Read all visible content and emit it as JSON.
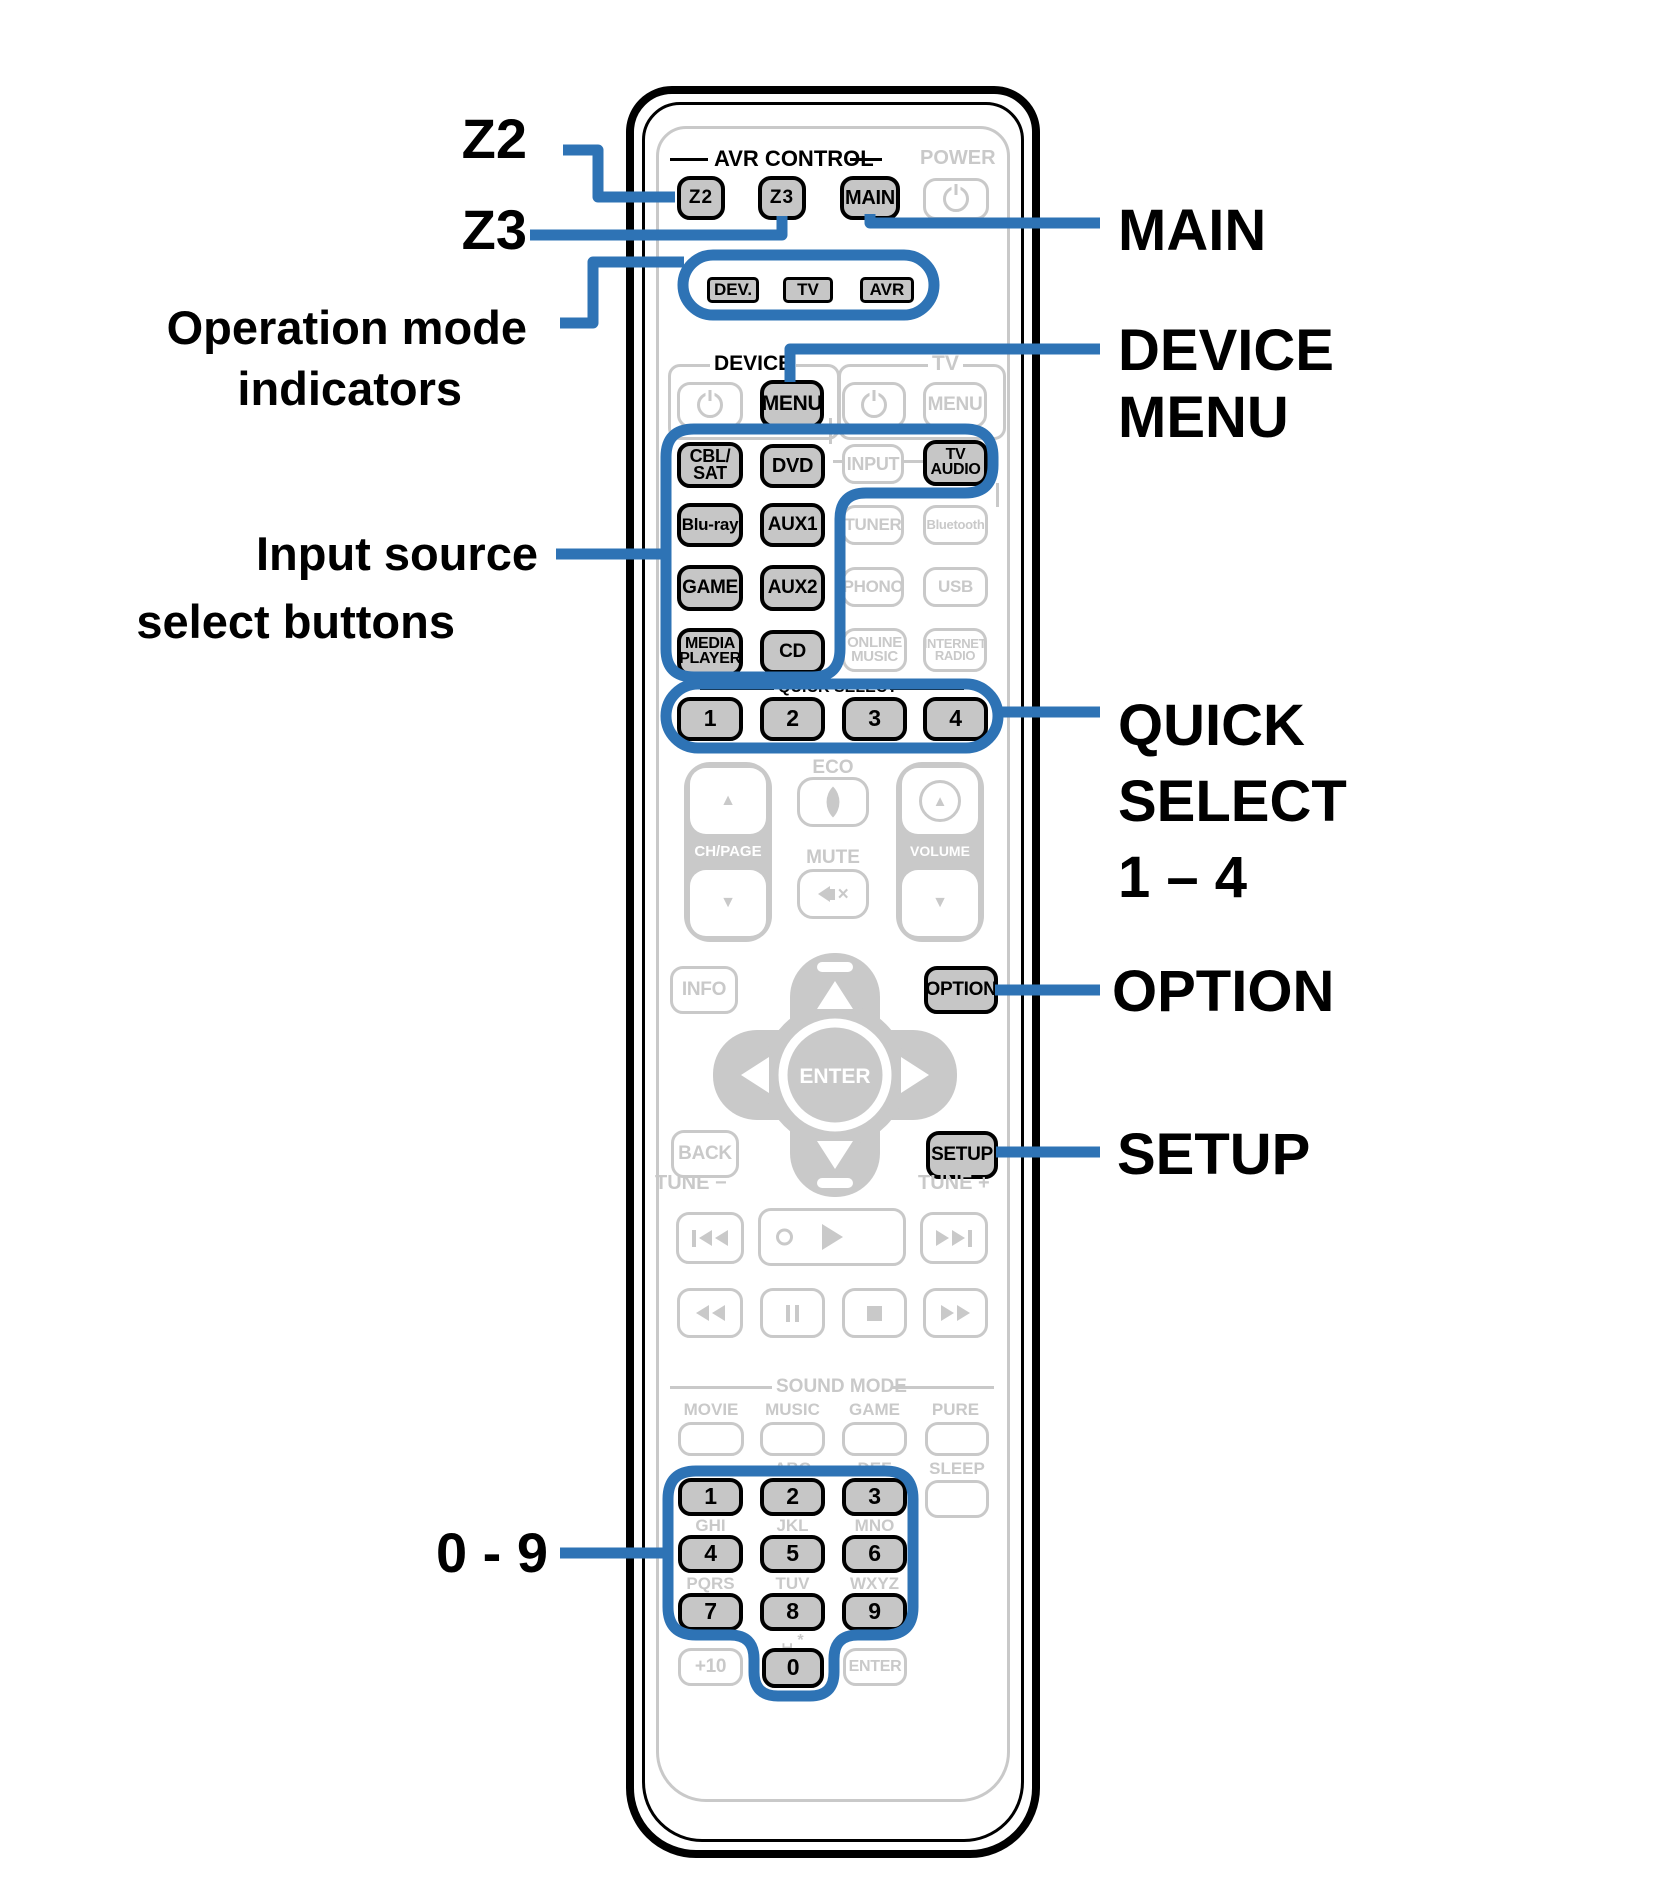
{
  "colors": {
    "callout_blue": "#2e73b5",
    "inactive_gray": "#c9c9c9",
    "highlight_fill": "#c6c6c6",
    "black": "#000000"
  },
  "callouts": {
    "z2": "Z2",
    "z3": "Z3",
    "operation_mode": [
      "Operation mode",
      "indicators"
    ],
    "input_source": [
      "Input source",
      "select buttons"
    ],
    "digits": "0 - 9",
    "main": "MAIN",
    "device_menu": [
      "DEVICE",
      "MENU"
    ],
    "quick_select": [
      "QUICK",
      "SELECT",
      "1 – 4"
    ],
    "option": "OPTION",
    "setup": "SETUP"
  },
  "remote": {
    "avr_control": {
      "title": "AVR CONTROL",
      "power_label": "POWER",
      "z2": "Z2",
      "z3": "Z3",
      "main": "MAIN"
    },
    "indicators": {
      "dev": "DEV.",
      "tv": "TV",
      "avr": "AVR"
    },
    "device": {
      "title": "DEVICE",
      "menu": "MENU"
    },
    "tv": {
      "title": "TV",
      "menu": "MENU"
    },
    "sources": {
      "cbl_sat": "CBL/ SAT",
      "dvd": "DVD",
      "input": "INPUT",
      "tv_audio": "TV AUDIO",
      "blu_ray": "Blu-ray",
      "aux1": "AUX1",
      "tuner": "TUNER",
      "bluetooth": "Bluetooth",
      "game": "GAME",
      "aux2": "AUX2",
      "phono": "PHONO",
      "usb": "USB",
      "media_player": "MEDIA PLAYER",
      "cd": "CD",
      "online_music": "ONLINE MUSIC",
      "internet_radio": "INTERNET RADIO"
    },
    "quick_select": {
      "title": "QUICK SELECT",
      "buttons": [
        "1",
        "2",
        "3",
        "4"
      ]
    },
    "center": {
      "eco": "ECO",
      "ch_page": "CH/PAGE",
      "mute": "MUTE",
      "volume": "VOLUME"
    },
    "nav": {
      "info": "INFO",
      "option": "OPTION",
      "enter": "ENTER",
      "back": "BACK",
      "setup": "SETUP"
    },
    "tune": {
      "minus": "TUNE −",
      "plus": "TUNE +"
    },
    "sound_mode": {
      "title": "SOUND MODE",
      "movie": "MOVIE",
      "music": "MUSIC",
      "game": "GAME",
      "pure": "PURE",
      "sleep": "SLEEP"
    },
    "keypad": {
      "digits": [
        "1",
        "2",
        "3",
        "4",
        "5",
        "6",
        "7",
        "8",
        "9",
        "0"
      ],
      "letters": [
        "ABC",
        "DEF",
        "GHI",
        "JKL",
        "MNO",
        "PQRS",
        "TUV",
        "WXYZ"
      ],
      "space_star": "␣ *",
      "plus10": "+10",
      "enter": "ENTER"
    },
    "icons": {
      "up": "▲",
      "down": "▼",
      "power": "standby-symbol",
      "eco": "leaf",
      "mute": "speaker-x",
      "volume_up": "circled-up-triangle",
      "record": "circle",
      "play": "triangle-right",
      "pause": "double-bar",
      "stop": "square",
      "skip_back": "prev-track",
      "skip_fwd": "next-track",
      "rewind": "double-triangle-left",
      "fast_fwd": "double-triangle-right"
    }
  }
}
